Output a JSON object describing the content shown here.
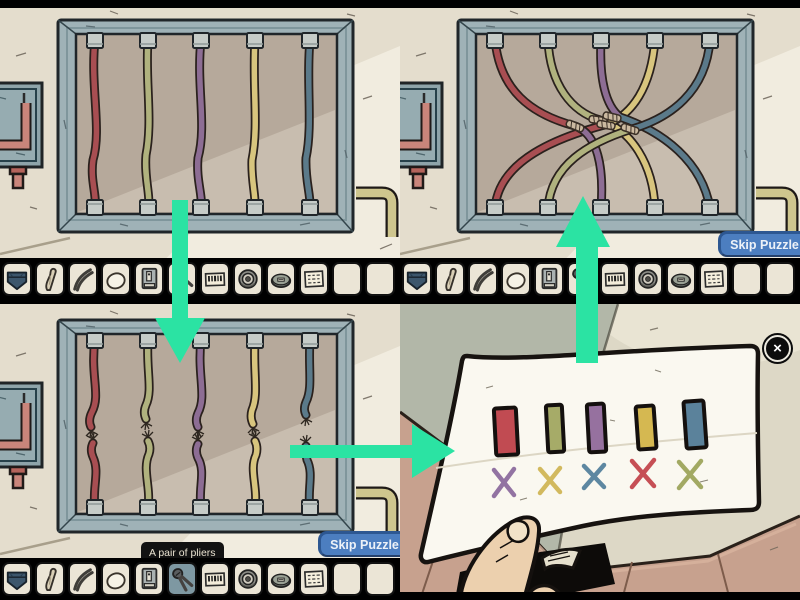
{
  "quadrants": {
    "top_left": {
      "name": "wires-intact-panel"
    },
    "top_right": {
      "name": "wires-connected-panel",
      "skip_button_label": "Skip Puzzle"
    },
    "bottom_left": {
      "name": "wires-cut-panel",
      "skip_button_label": "Skip Puzzle",
      "tooltip": "A pair of pliers",
      "selected_item": "pliers"
    },
    "bottom_right": {
      "name": "solution-note",
      "close_glyph": "×"
    }
  },
  "inventory": {
    "slots": [
      "pouch",
      "bone",
      "cutters",
      "egg",
      "matchbox",
      "pliers",
      "barcode",
      "dial",
      "tin",
      "note",
      "empty",
      "empty"
    ],
    "bottom_left_selected_index": 5
  },
  "puzzle": {
    "top_wire_order": [
      "red",
      "olive",
      "purple",
      "yellow",
      "blue"
    ],
    "note_swatch_order": [
      "red",
      "olive",
      "purple",
      "yellow",
      "blue"
    ],
    "note_mark_order": [
      "purple",
      "yellow",
      "blue",
      "red",
      "olive"
    ],
    "connections": [
      {
        "from": "red",
        "to": "purple"
      },
      {
        "from": "olive",
        "to": "yellow"
      },
      {
        "from": "purple",
        "to": "blue"
      },
      {
        "from": "yellow",
        "to": "red"
      },
      {
        "from": "blue",
        "to": "olive"
      }
    ]
  },
  "colors": {
    "arrow": "#2be3a3",
    "letterbox": "#000000",
    "wall": "#e4ddcd",
    "wall_light": "#f1ecdf",
    "panel_frame": "#9fb2b7",
    "panel_interior": "#b6a99b",
    "panel_interior_light": "#c8bdaf",
    "wire": {
      "red": "#a84e52",
      "olive": "#b0b27e",
      "purple": "#8d6d94",
      "yellow": "#d8c57e",
      "blue": "#5b7a8a"
    },
    "splice": "#cbb9a0",
    "connector": "#c6ccc8",
    "skip_button_bg": "#4c7ec0",
    "skip_button_edge": "#2d5791",
    "skip_button_text": "#edf2f8",
    "tooltip_bg": "#121212",
    "tooltip_text": "#eae3d1",
    "inventory_bg": "#000000",
    "slot_bg": "#ebe5d6",
    "slot_selected_bg": "#7e98a2",
    "paper": "#faf8f0",
    "swatch": {
      "red": "#c14b52",
      "olive": "#a6ab68",
      "purple": "#96719f",
      "yellow": "#d5b851",
      "blue": "#5b829b"
    },
    "mark": {
      "purple": "#9273a2",
      "yellow": "#d2b95e",
      "blue": "#5d87a1",
      "red": "#c64f55",
      "olive": "#a2a963"
    },
    "skin": "#ecd0ae",
    "floor": "#c7a18e",
    "side_wall": "#b2b7a8"
  }
}
